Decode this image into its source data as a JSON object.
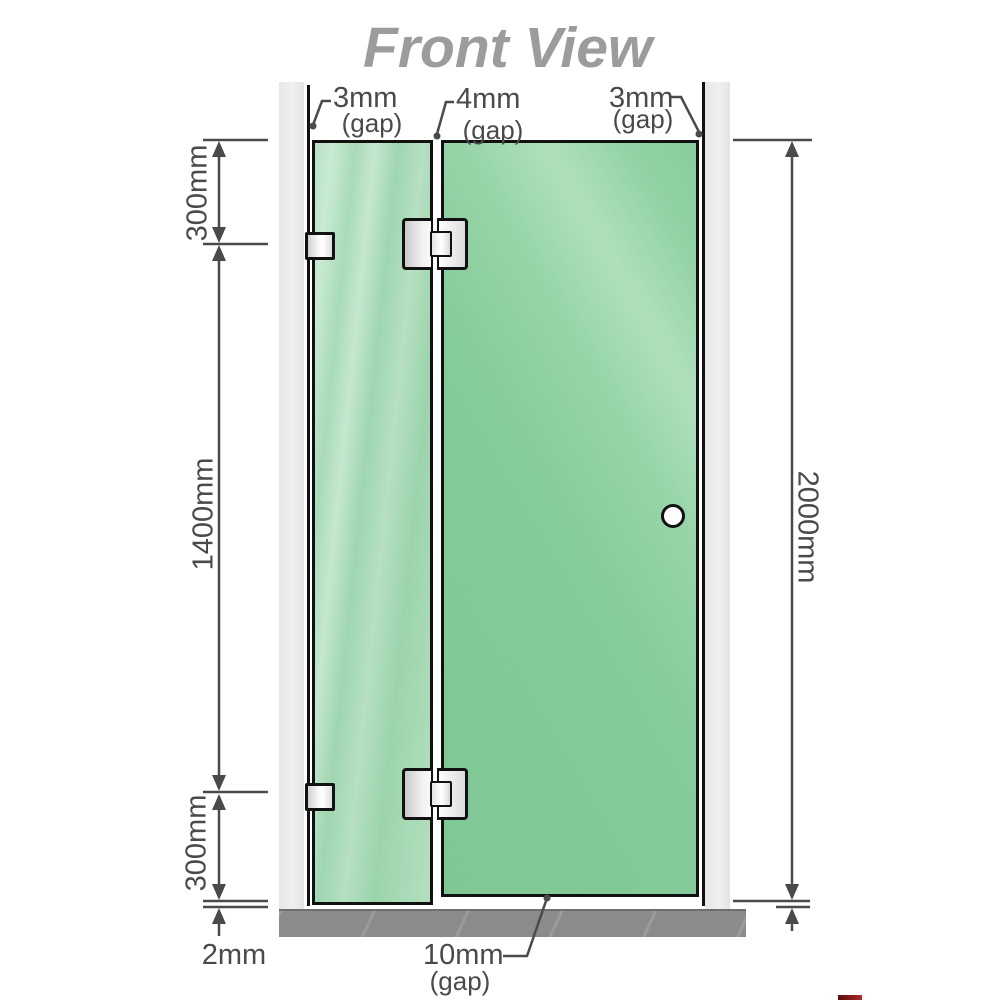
{
  "title": "Front View",
  "top_labels": [
    {
      "value": "3mm",
      "gap": "(gap)"
    },
    {
      "value": "4mm",
      "gap": "(gap)"
    },
    {
      "value": "3mm",
      "gap": "(gap)"
    }
  ],
  "left_dims": {
    "top": "300mm",
    "middle": "1400mm",
    "bottom": "300mm",
    "floor_gap": "2mm"
  },
  "right_dims": {
    "total": "2000mm"
  },
  "bottom_gap": {
    "value": "10mm",
    "gap": "(gap)"
  },
  "colors": {
    "title_gray": "#9c9c9c",
    "dim_gray": "#4a4a4a",
    "wall_rail": "#ececec",
    "floor_gray": "#8b8b8b",
    "glass_fixed": "#aedcba",
    "glass_door": "#87cc9b",
    "hardware_silver": "#e8e8e8",
    "outline_black": "#111111",
    "logo_red": "#8e1b1b"
  }
}
